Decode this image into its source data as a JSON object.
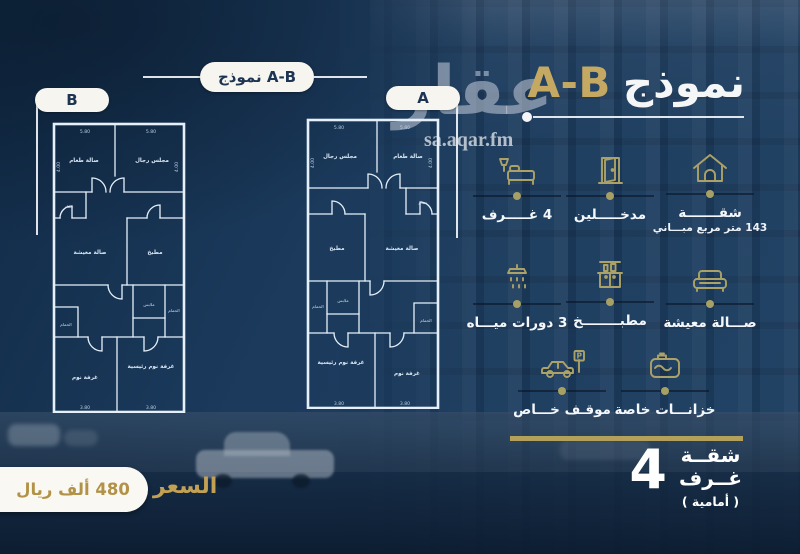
{
  "colors": {
    "gold": "#c5a963",
    "olive": "#aca267",
    "navy": "#1b3a5c",
    "pill": "#f7f5f0"
  },
  "header": {
    "pill_label": "نموذج A-B",
    "title_word": "نموذج",
    "title_code": "A-B"
  },
  "watermark": {
    "logo": "عقار",
    "site": "sa.aqar.fm"
  },
  "plans": {
    "b": {
      "tag": "B",
      "rooms": {
        "top_left": "صالة طعام",
        "top_right": "مجلس رجال",
        "wc_top": "حمام",
        "mid_left": "صالة معيشة",
        "mid_right": "مطبخ",
        "dressing": "ملابس",
        "wc_mid": "الحمام",
        "wc_small": "الحمام",
        "bottom_left": "غرفة نوم",
        "bottom_right": "غرفة نوم رئيسية"
      },
      "dims": {
        "top_left": "5.80",
        "top_right": "5.80",
        "side_left": "4.00",
        "side_right": "4.00",
        "bottom_left": "3.80",
        "bottom_right": "3.80"
      }
    },
    "a": {
      "tag": "A",
      "rooms": {
        "top_left": "مجلس رجال",
        "top_right": "صالة طعام",
        "wc_top": "حمام",
        "mid_left": "مطبخ",
        "mid_right": "صالة معيشة",
        "dressing": "ملابس",
        "wc_mid": "الحمام",
        "wc_small": "الحمام",
        "bottom_left": "غرفة نوم رئيسية",
        "bottom_right": "غرفة نوم"
      },
      "dims": {
        "top_left": "5.80",
        "top_right": "5.80",
        "side_left": "4.00",
        "side_right": "4.00",
        "bottom_left": "3.80",
        "bottom_right": "3.80"
      }
    }
  },
  "features": {
    "rooms": {
      "label": "4 غـــــرف"
    },
    "entrances": {
      "label": "مدخـــــلين"
    },
    "apartment": {
      "line1": "شقـــــــة",
      "line2": "143 متر مربع مبـــاني"
    },
    "bathrooms": {
      "label": "3 دورات ميـــاه"
    },
    "kitchen": {
      "label": "مطبــــــــخ"
    },
    "living": {
      "label": "صـــالة معيشة"
    },
    "parking": {
      "label": "موقـف خـــاص",
      "sign_letter": "P"
    },
    "tanks": {
      "label": "خزانـــات خاصة"
    }
  },
  "summary": {
    "count": "4",
    "word1": "شقــة",
    "word2": "غــرف",
    "note": "( أمامية )"
  },
  "price": {
    "label": "السعر",
    "value": "480 ألف ريال"
  }
}
